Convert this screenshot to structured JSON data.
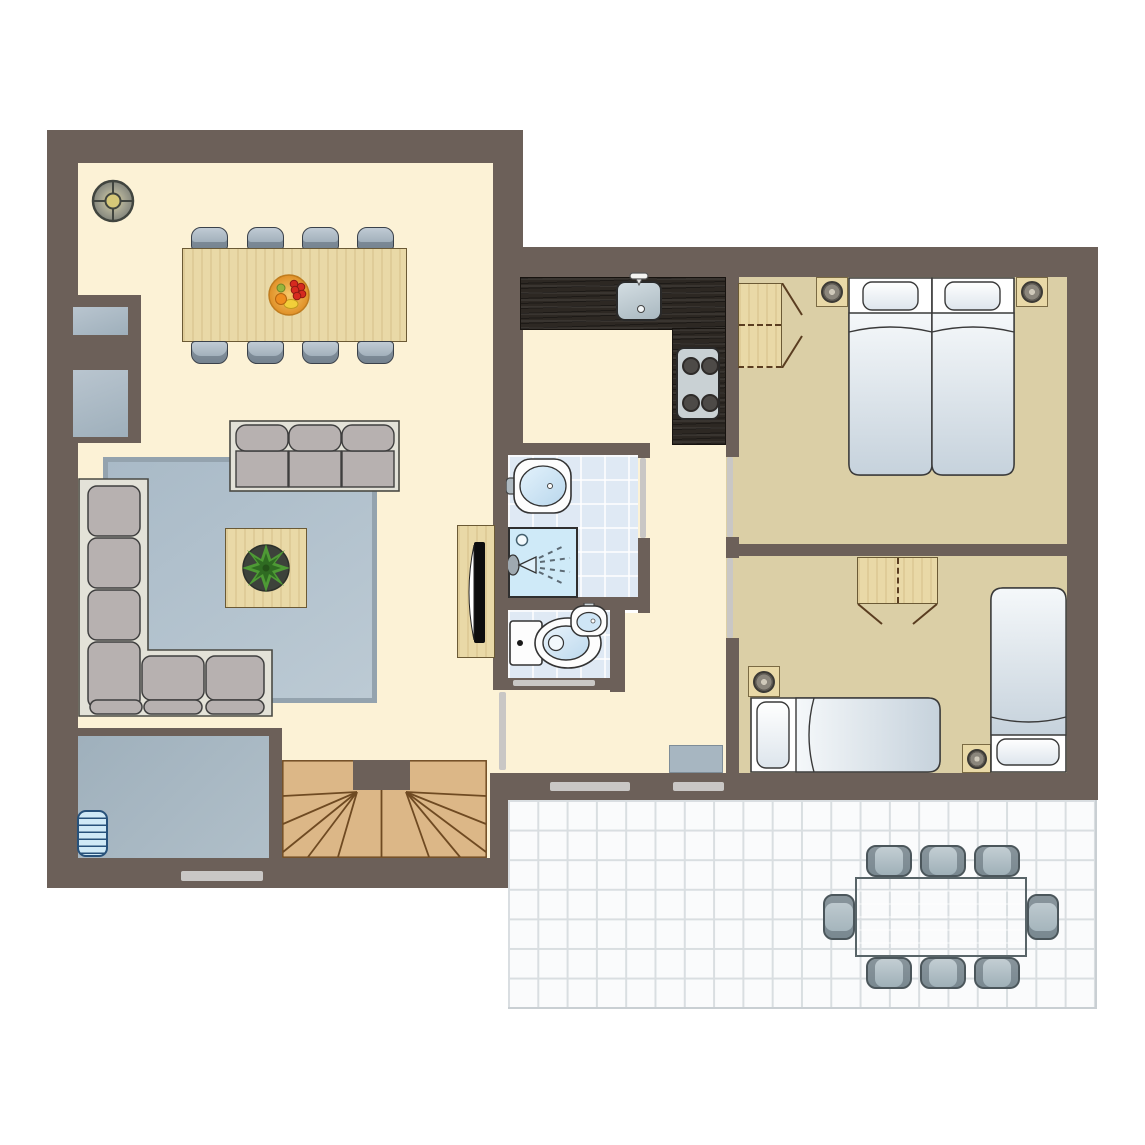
{
  "meta": {
    "title": "floor-plan",
    "type": "architectural-floor-plan",
    "visible_text": []
  },
  "colors": {
    "wall": "#6c6059",
    "floor-living": "#fcf2d6",
    "floor-bed": "#dbcfa6",
    "tile": "#dfe9f4",
    "shower": "#cfeaf8",
    "counter": "#2d2823",
    "wood": "#e9d9a7",
    "wood-border": "#6b5a35",
    "stair": "#dcb787",
    "stair-line": "#6f4a22",
    "rug": "#b3c2ce",
    "rug-border": "#94a3ae",
    "sofa-frame": "#e3e2d8",
    "cushion": "#b7b1b0",
    "chair": "#aebbc6",
    "outline": "#3f3f3f",
    "terrace": "#fafbfc",
    "terrace-grid": "#d9dee1",
    "outdoor": "#b4c1c7",
    "utility": "#a3b2bd",
    "radiator": "#cfe9f6",
    "door": "#c9c7c5"
  },
  "rooms": [
    {
      "id": "living-room",
      "floor": "cream"
    },
    {
      "id": "kitchen",
      "floor": "cream"
    },
    {
      "id": "hallway",
      "floor": "cream"
    },
    {
      "id": "bathroom",
      "floor": "blue-tile"
    },
    {
      "id": "wc",
      "floor": "blue-tile"
    },
    {
      "id": "bedroom-1",
      "floor": "tan"
    },
    {
      "id": "bedroom-2",
      "floor": "tan"
    },
    {
      "id": "utility-room",
      "floor": "blue-gray"
    },
    {
      "id": "staircase",
      "floor": "wood"
    },
    {
      "id": "terrace",
      "floor": "white-tile"
    }
  ],
  "furniture": {
    "living_room": [
      "ceiling-light",
      "fireplace",
      "dining-table",
      "dining-chair x8",
      "fruit-bowl",
      "sofa-3-seat",
      "corner-sofa",
      "rug",
      "coffee-table",
      "plant",
      "tv-cabinet",
      "tv"
    ],
    "kitchen": [
      "l-shaped-counter",
      "kitchen-sink",
      "faucet",
      "stove-4-burner"
    ],
    "bathroom": [
      "washbasin",
      "shower"
    ],
    "wc": [
      "toilet",
      "small-washbasin"
    ],
    "bedroom_1": [
      "wardrobe",
      "nightstand x2",
      "table-lamp x2",
      "single-bed x2"
    ],
    "bedroom_2": [
      "wardrobe",
      "nightstand x2",
      "table-lamp x2",
      "single-bed x2",
      "doormat"
    ],
    "utility_room": [
      "radiator"
    ],
    "staircase": [
      "winder-stairs"
    ],
    "terrace": [
      "outdoor-table",
      "outdoor-chair x8"
    ]
  }
}
